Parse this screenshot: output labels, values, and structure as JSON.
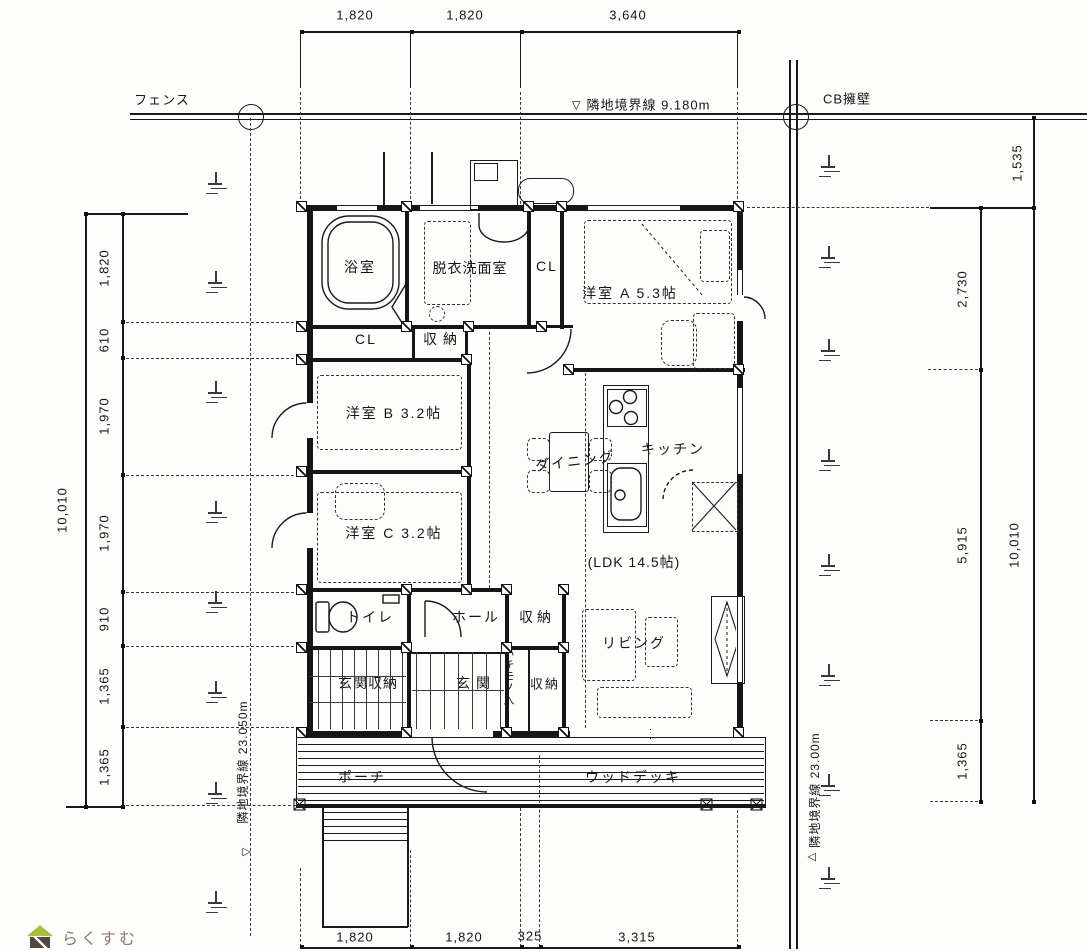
{
  "site": {
    "fence_label": "フェンス",
    "boundary_top_label": "隣地境界線 9.180m",
    "cb_wall_label": "CB擁壁",
    "boundary_left_label": "隣地境界線 23.050m",
    "boundary_right_label": "隣地境界線 23.00m"
  },
  "icons": {
    "triangle_down": "▽",
    "triangle_up": "△"
  },
  "rooms": {
    "bath": "浴室",
    "washroom": "脱衣洗面室",
    "closet_a": "CL",
    "room_a": "洋室 A 5.3帖",
    "closet_b": "CL",
    "storage_top": "収納",
    "room_b": "洋室 B 3.2帖",
    "dining": "ダイニング",
    "kitchen": "キッチン",
    "room_c": "洋室 C 3.2帖",
    "ldk": "(LDK 14.5帖)",
    "toilet": "トイレ",
    "hall": "ホール",
    "storage_hall": "収納",
    "living": "リビング",
    "entrance_storage": "玄関収納",
    "entrance": "玄関",
    "shoe_storage": "ハキモノ入",
    "storage_entrance": "収納",
    "porch": "ポーチ",
    "wood_deck": "ウッドデッキ"
  },
  "dimensions": {
    "top": [
      "1,820",
      "1,820",
      "3,640"
    ],
    "bottom": [
      "1,820",
      "1,820",
      "325",
      "3,315"
    ],
    "left": [
      "1,820",
      "610",
      "1,970",
      "1,970",
      "910",
      "1,365",
      "1,365"
    ],
    "left_total": "10,010",
    "right": [
      "2,730",
      "5,915",
      "1,365"
    ],
    "right_total": "10,010",
    "right_top": "1,535"
  },
  "logo": {
    "text": "らくすむ"
  },
  "colors": {
    "line": "#1a1a1a",
    "logo_green": "#a8c03a",
    "logo_brown": "#55463e",
    "logo_text": "#8d7b70"
  }
}
